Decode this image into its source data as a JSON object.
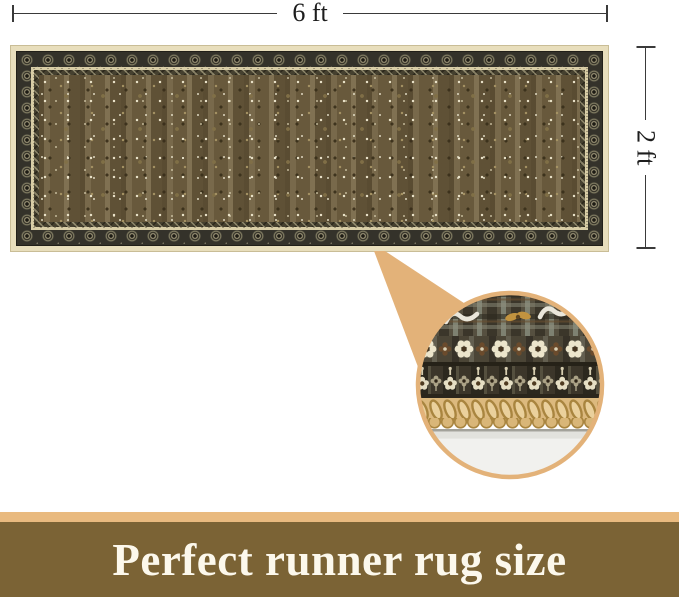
{
  "dimensions": {
    "width_label": "6 ft",
    "height_label": "2 ft"
  },
  "rug": {
    "name": "vintage-brown-oriental-runner-rug"
  },
  "magnifier": {
    "name": "rug-edge-closeup"
  },
  "banner": {
    "text": "Perfect runner rug size"
  },
  "theme": {
    "--line-color": "#3a3a3a",
    "--label-color": "#1d1d1d",
    "--tan": "#e3b279",
    "--banner-strip": "#e9ba7f",
    "--banner-bg": "#7b6335",
    "--banner-text": "#fcf8ec",
    "--rug-binding": "#e8debc",
    "--rug-field": "#6d5d3f",
    "--floor": "#f1f1ee"
  }
}
